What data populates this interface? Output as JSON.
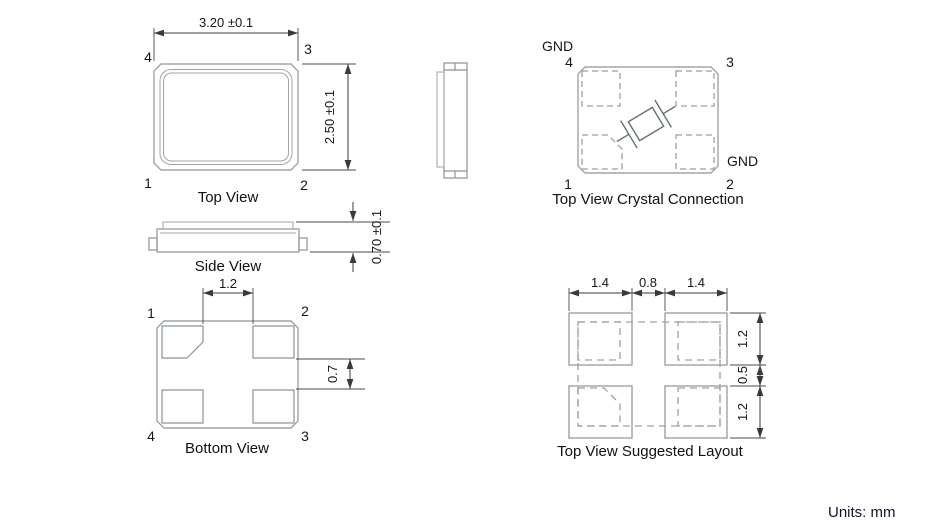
{
  "footer": {
    "units": "Units: mm"
  },
  "views": {
    "top": {
      "caption": "Top View",
      "dim_width": "3.20 ±0.1",
      "dim_height": "2.50 ±0.1",
      "pin_tl": "4",
      "pin_tr": "3",
      "pin_bl": "1",
      "pin_br": "2"
    },
    "side": {
      "caption": "Side View",
      "dim_height": "0.70 ±0.1"
    },
    "bottom": {
      "caption": "Bottom View",
      "dim_pad_gap": "1.2",
      "dim_pad_height": "0.7",
      "pin_tl": "1",
      "pin_tr": "2",
      "pin_bl": "4",
      "pin_br": "3"
    },
    "crystal": {
      "caption": "Top View Crystal Connection",
      "gnd_top": "GND",
      "gnd_right": "GND",
      "pin_tl": "4",
      "pin_tr": "3",
      "pin_bl": "1",
      "pin_br": "2"
    },
    "layout": {
      "caption": "Top View Suggested Layout",
      "dims_top": [
        "1.4",
        "0.8",
        "1.4"
      ],
      "dims_right": [
        "1.2",
        "0.5",
        "1.2"
      ]
    }
  }
}
